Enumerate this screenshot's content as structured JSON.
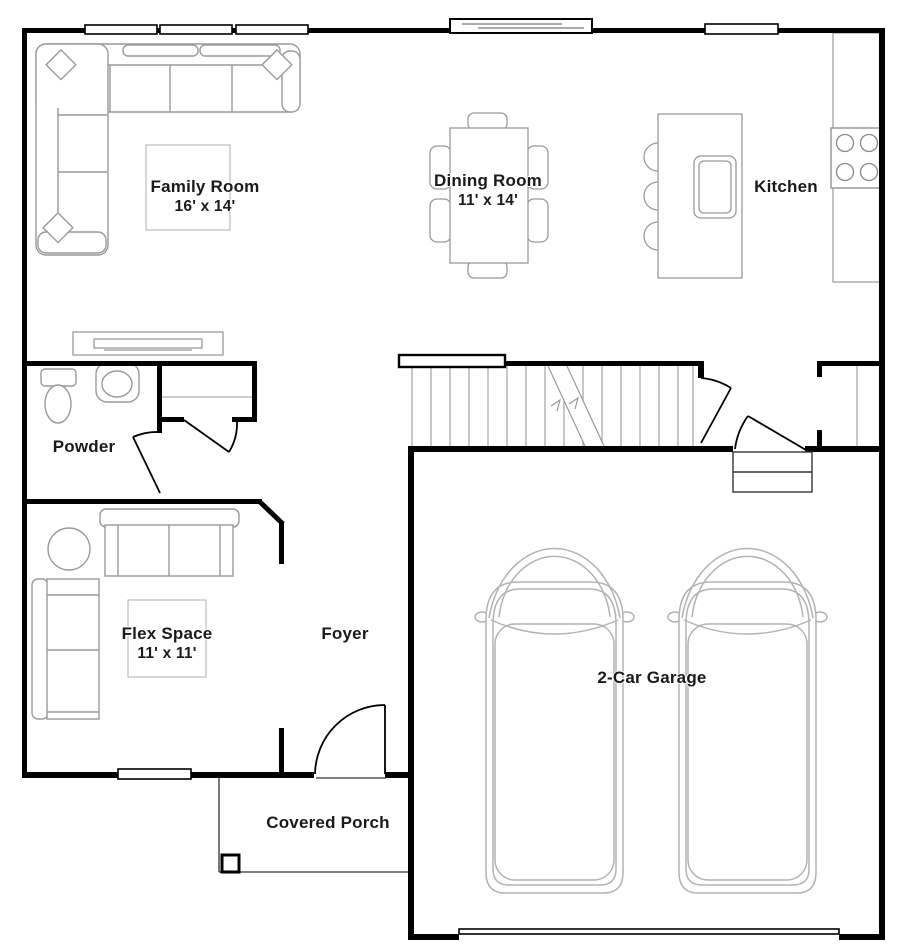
{
  "colors": {
    "walls": "#000000",
    "furniture_lines": "#9a9a9a",
    "rug_lines": "#bdbdbd",
    "car_lines": "#b3b3b3",
    "text": "#1a1a1a",
    "background": "#ffffff"
  },
  "rooms": {
    "family_room": {
      "label": "Family Room",
      "dimensions": "16' x 14'"
    },
    "dining_room": {
      "label": "Dining Room",
      "dimensions": "11' x 14'"
    },
    "kitchen": {
      "label": "Kitchen"
    },
    "powder": {
      "label": "Powder"
    },
    "flex_space": {
      "label": "Flex Space",
      "dimensions": "11' x 11'"
    },
    "foyer": {
      "label": "Foyer"
    },
    "garage": {
      "label": "2-Car Garage"
    },
    "covered_porch": {
      "label": "Covered Porch"
    }
  }
}
